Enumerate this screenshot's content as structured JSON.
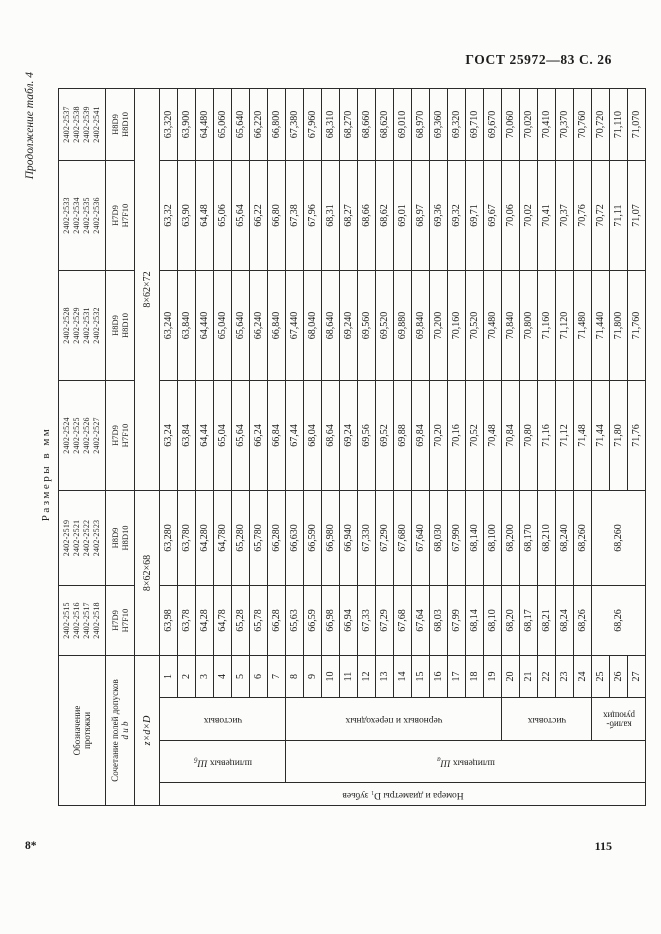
{
  "page": {
    "gost_header": "ГОСТ 25972—83 С. 26",
    "continuation_note": "Продолжение табл. 4",
    "units_note": "Размеры в мм",
    "signature_mark": "8*",
    "page_number": "115"
  },
  "table": {
    "stub": {
      "designation_header": [
        "Обозначение",
        "протяжки"
      ],
      "tolerance_header_line1": "Сочетание полей допусков",
      "tolerance_header_line2": "d и b",
      "size_header": "z×d×D",
      "side_label": "Номера и диаметры D₁ зубьев",
      "tooth_groups": [
        {
          "lines": [
            "чистовых"
          ],
          "from": 1,
          "to": 7
        },
        {
          "lines": [
            "черновых и переходных"
          ],
          "from": 8,
          "to": 19
        },
        {
          "lines": [
            "чистовых"
          ],
          "from": 20,
          "to": 24
        },
        {
          "lines": [
            "калиб-",
            "рующих"
          ],
          "from": 25,
          "to": 27
        }
      ],
      "spline_sections": [
        {
          "prefix": "шлицевых ",
          "symbol": "Ш",
          "sub": "б",
          "from": 1,
          "to": 7
        },
        {
          "prefix": "шлицевых ",
          "symbol": "Ш",
          "sub": "а",
          "from": 8,
          "to": 27
        }
      ]
    },
    "sizes": [
      {
        "label": "8×62×68",
        "colspan": 2
      },
      {
        "label": "8×62×72",
        "colspan": 4
      }
    ],
    "row_count": 27,
    "columns": [
      {
        "broaches": [
          "2402-2515",
          "2402-2516",
          "2402-2517",
          "2402-2518"
        ],
        "tolerances": [
          "H7D9",
          "H7F10"
        ],
        "values": [
          "63,98",
          "63,78",
          "64,28",
          "64,78",
          "65,28",
          "65,78",
          "66,28",
          "65,63",
          "66,59",
          "66,98",
          "66,94",
          "67,33",
          "67,29",
          "67,68",
          "67,64",
          "68,03",
          "67,99",
          "68,14",
          "68,10",
          "68,20",
          "68,17",
          "68,21",
          "68,24",
          "68,26"
        ],
        "merged_value": "68,26",
        "merged_rows": "25–27"
      },
      {
        "broaches": [
          "2402-2519",
          "2402-2521",
          "2402-2522",
          "2402-2523"
        ],
        "tolerances": [
          "H8D9",
          "H8D10"
        ],
        "values": [
          "63,280",
          "63,780",
          "64,280",
          "64,780",
          "65,280",
          "65,780",
          "66,280",
          "66,630",
          "66,590",
          "66,980",
          "66,940",
          "67,330",
          "67,290",
          "67,680",
          "67,640",
          "68,030",
          "67,990",
          "68,140",
          "68,100",
          "68,200",
          "68,170",
          "68,210",
          "68,240",
          "68,260"
        ],
        "merged_value": "68,260",
        "merged_rows": "25–27"
      },
      {
        "broaches": [
          "2402-2524",
          "2402-2525",
          "2402-2526",
          "2402-2527"
        ],
        "tolerances": [
          "H7D9",
          "H7F10"
        ],
        "values": [
          "63,24",
          "63,84",
          "64,44",
          "65,04",
          "65,64",
          "66,24",
          "66,84",
          "67,44",
          "68,04",
          "68,64",
          "69,24",
          "69,56",
          "69,52",
          "69,88",
          "69,84",
          "70,20",
          "70,16",
          "70,52",
          "70,48",
          "70,84",
          "70,80",
          "71,16",
          "71,12",
          "71,48",
          "71,44",
          "71,80",
          "71,76"
        ],
        "merged_value": null
      },
      {
        "broaches": [
          "2402-2528",
          "2402-2529",
          "2402-2531",
          "2402-2532"
        ],
        "tolerances": [
          "H8D9",
          "H8D10"
        ],
        "values": [
          "63,240",
          "63,840",
          "64,440",
          "65,040",
          "65,640",
          "66,240",
          "66,840",
          "67,440",
          "68,040",
          "68,640",
          "69,240",
          "69,560",
          "69,520",
          "69,880",
          "69,840",
          "70,200",
          "70,160",
          "70,520",
          "70,480",
          "70,840",
          "70,800",
          "71,160",
          "71,120",
          "71,480",
          "71,440",
          "71,800",
          "71,760"
        ],
        "merged_value": null
      },
      {
        "broaches": [
          "2402-2533",
          "2402-2534",
          "2402-2535",
          "2402-2536"
        ],
        "tolerances": [
          "H7D9",
          "H7F10"
        ],
        "values": [
          "63,32",
          "63,90",
          "64,48",
          "65,06",
          "65,64",
          "66,22",
          "66,80",
          "67,38",
          "67,96",
          "68,31",
          "68,27",
          "68,66",
          "68,62",
          "69,01",
          "68,97",
          "69,36",
          "69,32",
          "69,71",
          "69,67",
          "70,06",
          "70,02",
          "70,41",
          "70,37",
          "70,76",
          "70,72",
          "71,11",
          "71,07"
        ],
        "merged_value": null
      },
      {
        "broaches": [
          "2402-2537",
          "2402-2538",
          "2402-2539",
          "2402-2541"
        ],
        "tolerances": [
          "H8D9",
          "H8D10"
        ],
        "values": [
          "63,320",
          "63,900",
          "64,480",
          "65,060",
          "65,640",
          "66,220",
          "66,800",
          "67,380",
          "67,960",
          "68,310",
          "68,270",
          "68,660",
          "68,620",
          "69,010",
          "68,970",
          "69,360",
          "69,320",
          "69,710",
          "69,670",
          "70,060",
          "70,020",
          "70,410",
          "70,370",
          "70,760",
          "70,720",
          "71,110",
          "71,070"
        ],
        "merged_value": null
      }
    ]
  }
}
